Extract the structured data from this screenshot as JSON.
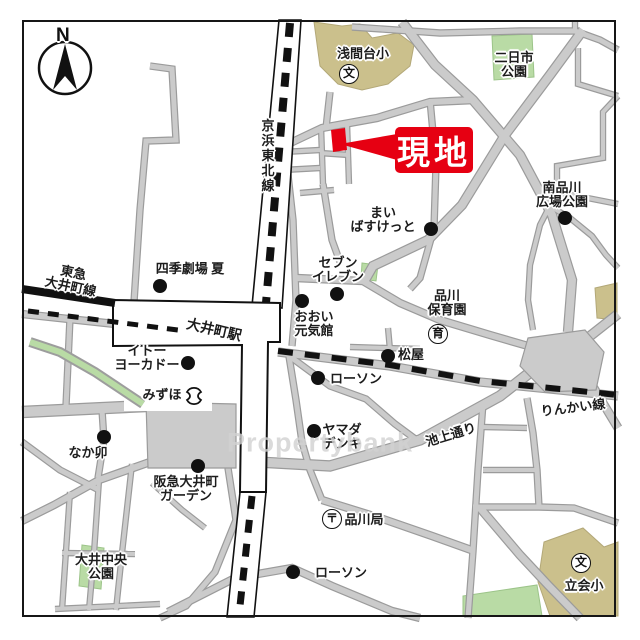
{
  "map": {
    "title_hint": "site location map around Oimachi Station",
    "compass": {
      "label": "N"
    },
    "watermark": "Propertybank",
    "site_callout": {
      "label": "現地"
    },
    "colors": {
      "accent_red": "#e60012",
      "school_tan": "#cbc08c",
      "park_green": "#b9dba5",
      "road_fill": "#cbcbcb",
      "road_edge": "#9b9b9b",
      "rail_black": "#111111"
    },
    "labels": [
      {
        "id": "keihin-tohoku-line",
        "text": "京浜東北線",
        "x": 267,
        "y": 156,
        "rot": 0,
        "size": 13,
        "vertical": true
      },
      {
        "id": "tokyu-oimachi-line",
        "text": "東急\n大井町線",
        "x": 72,
        "y": 280,
        "rot": 12,
        "size": 13
      },
      {
        "id": "shiki-theatre-natsu",
        "text": "四季劇場 夏",
        "x": 190,
        "y": 269,
        "rot": 0,
        "size": 13
      },
      {
        "id": "sengendai-elementary",
        "text": "浅間台小",
        "x": 363,
        "y": 54,
        "rot": 0,
        "size": 13
      },
      {
        "id": "futsukaichi-park",
        "text": "二日市\n公園",
        "x": 514,
        "y": 65,
        "rot": 0,
        "size": 13
      },
      {
        "id": "minami-shinagawa-hiroba-park",
        "text": "南品川\n広場公園",
        "x": 562,
        "y": 195,
        "rot": 0,
        "size": 13
      },
      {
        "id": "my-basket",
        "text": "まい\nばすけっと",
        "x": 383,
        "y": 220,
        "rot": 0,
        "size": 13
      },
      {
        "id": "seven-eleven",
        "text": "セブン\nイレブン",
        "x": 338,
        "y": 270,
        "rot": 0,
        "size": 13
      },
      {
        "id": "ooi-genkikan",
        "text": "おおい\n元気館",
        "x": 314,
        "y": 324,
        "rot": 0,
        "size": 13
      },
      {
        "id": "shinagawa-hoikuen",
        "text": "品川\n保育園",
        "x": 447,
        "y": 303,
        "rot": 0,
        "size": 13
      },
      {
        "id": "matsuya",
        "text": "松屋",
        "x": 411,
        "y": 355,
        "rot": 0,
        "size": 13
      },
      {
        "id": "lawson-upper",
        "text": "ローソン",
        "x": 356,
        "y": 379,
        "rot": 0,
        "size": 13
      },
      {
        "id": "oimachi-station",
        "text": "大井町駅",
        "x": 214,
        "y": 330,
        "rot": 13,
        "size": 14
      },
      {
        "id": "ito-yokado",
        "text": "イトー\nヨーカドー",
        "x": 147,
        "y": 358,
        "rot": 0,
        "size": 13
      },
      {
        "id": "mizuho",
        "text": "みずほ",
        "x": 162,
        "y": 395,
        "rot": 0,
        "size": 13
      },
      {
        "id": "nakau",
        "text": "なか卯",
        "x": 88,
        "y": 453,
        "rot": 0,
        "size": 13
      },
      {
        "id": "hankyu-oimachi-garden",
        "text": "阪急大井町\nガーデン",
        "x": 186,
        "y": 489,
        "rot": 0,
        "size": 13
      },
      {
        "id": "yamada-denki",
        "text": "ヤマダ\nデンキ",
        "x": 342,
        "y": 437,
        "rot": 0,
        "size": 13
      },
      {
        "id": "ikegami-dori",
        "text": "池上通り",
        "x": 451,
        "y": 435,
        "rot": -17,
        "size": 13
      },
      {
        "id": "rinkai-line",
        "text": "りんかい線",
        "x": 573,
        "y": 408,
        "rot": -7,
        "size": 13
      },
      {
        "id": "shinagawa-post-office",
        "text": "品川局",
        "x": 364,
        "y": 520,
        "rot": 0,
        "size": 13
      },
      {
        "id": "lawson-lower",
        "text": "ローソン",
        "x": 341,
        "y": 573,
        "rot": 0,
        "size": 13
      },
      {
        "id": "oi-chuo-park",
        "text": "大井中央\n公園",
        "x": 101,
        "y": 567,
        "rot": 0,
        "size": 13
      },
      {
        "id": "tachiai-elementary",
        "text": "立会小",
        "x": 584,
        "y": 586,
        "rot": 0,
        "size": 13
      }
    ],
    "poi_dots": [
      {
        "for": "shiki-theatre-natsu",
        "x": 160,
        "y": 286
      },
      {
        "for": "my-basket",
        "x": 431,
        "y": 229
      },
      {
        "for": "seven-eleven",
        "x": 337,
        "y": 294
      },
      {
        "for": "ooi-genkikan",
        "x": 302,
        "y": 301
      },
      {
        "for": "minami-shinagawa-hiroba-park",
        "x": 565,
        "y": 218
      },
      {
        "for": "matsuya",
        "x": 388,
        "y": 356
      },
      {
        "for": "lawson-upper",
        "x": 318,
        "y": 378
      },
      {
        "for": "ito-yokado",
        "x": 188,
        "y": 363
      },
      {
        "for": "nakau",
        "x": 104,
        "y": 437
      },
      {
        "for": "hankyu-oimachi-garden",
        "x": 198,
        "y": 466
      },
      {
        "for": "yamada-denki",
        "x": 314,
        "y": 431
      },
      {
        "for": "lawson-lower",
        "x": 293,
        "y": 572
      }
    ],
    "symbols": [
      {
        "glyph": "文",
        "meaning": "school",
        "x": 349,
        "y": 74
      },
      {
        "glyph": "文",
        "meaning": "school",
        "x": 581,
        "y": 563
      },
      {
        "glyph": "〒",
        "meaning": "post-office",
        "x": 332,
        "y": 519
      },
      {
        "glyph": "育",
        "meaning": "nursery",
        "x": 438,
        "y": 334
      }
    ],
    "bank_symbol": {
      "meaning": "bank",
      "x": 194,
      "y": 396
    }
  }
}
